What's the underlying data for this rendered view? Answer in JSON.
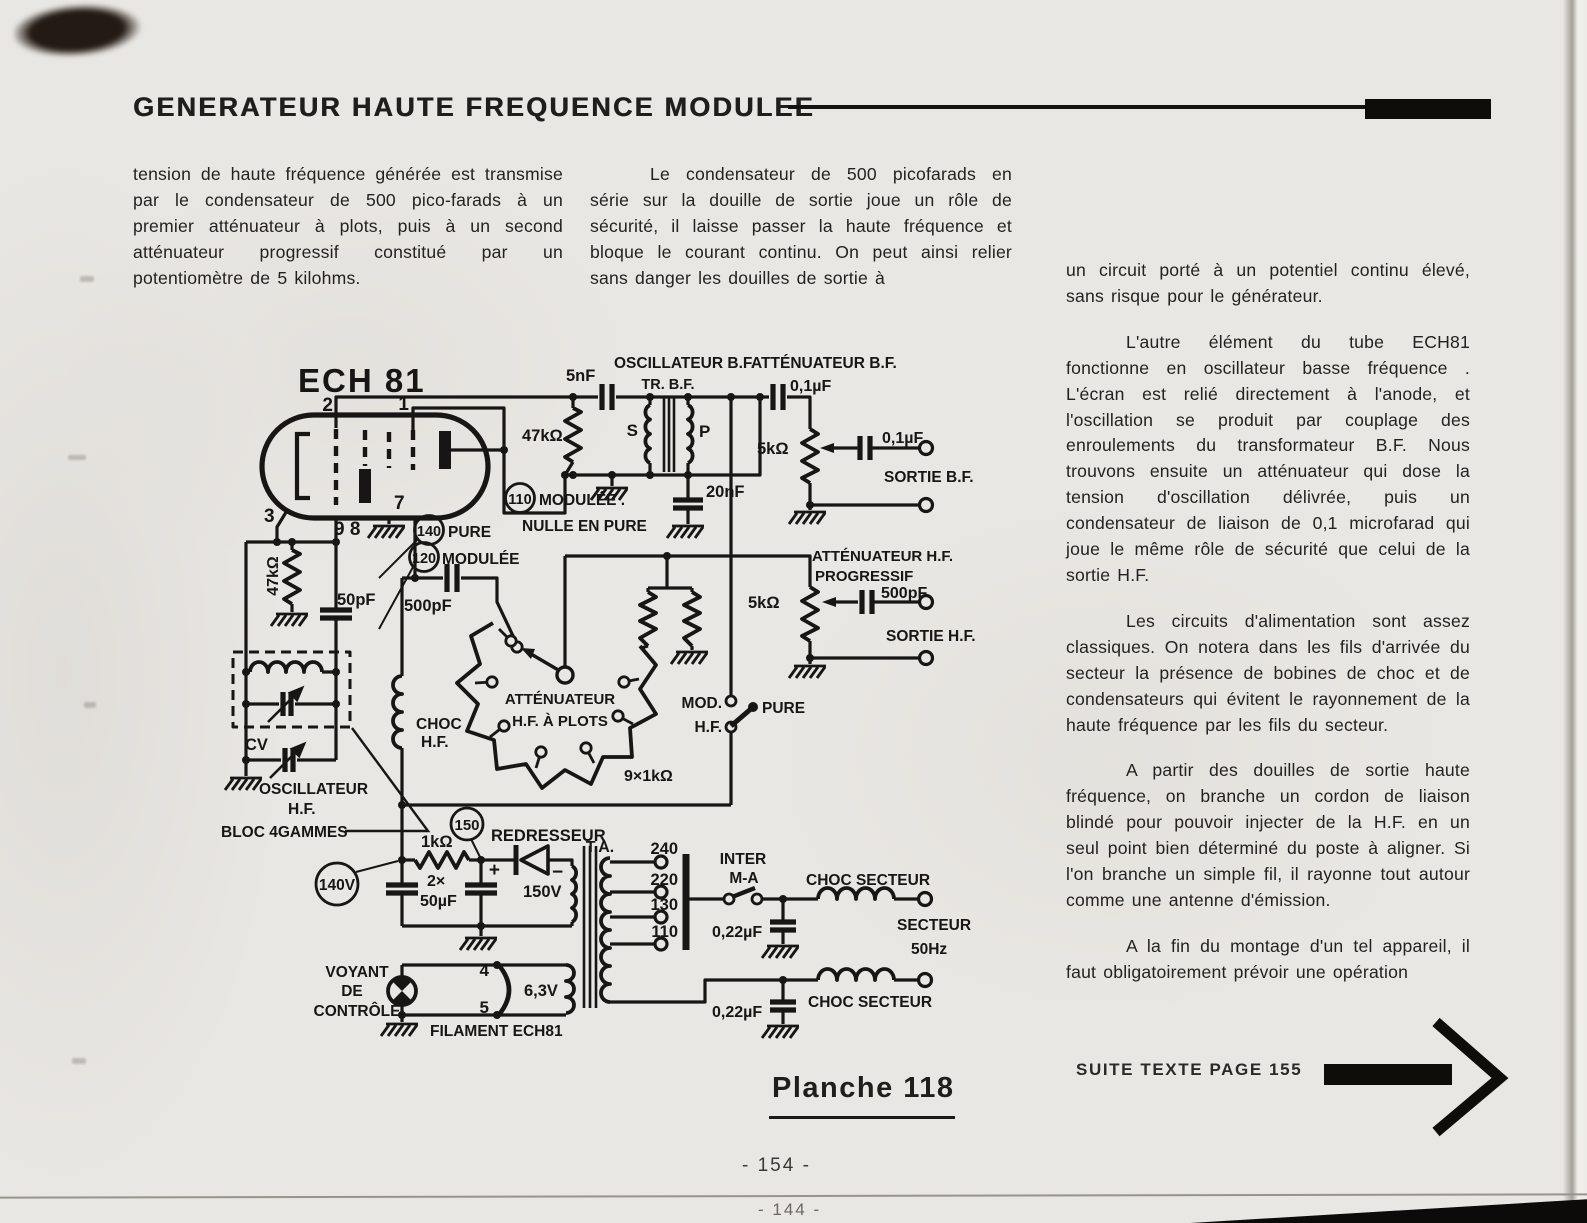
{
  "header": {
    "title": "GENERATEUR HAUTE FREQUENCE MODULEE"
  },
  "body": {
    "col_left": "tension de haute fréquence générée est transmise par le condensateur de 500 pico-farads à un premier atténuateur à plots, puis à un second atténuateur progressif constitué par un potentiomètre de 5 kilohms.",
    "col_middle": "Le condensateur de 500 picofarads en série sur la douille de sortie joue un rôle de sécurité, il laisse passer la haute fréquence et bloque le courant continu. On peut ainsi relier sans danger les douilles de sortie à",
    "col_right_p1": "un circuit porté à un potentiel continu élevé, sans risque pour le générateur.",
    "col_right_p2": "L'autre élément du tube ECH81 fonctionne en oscillateur basse fréquence . L'écran est relié directement à l'anode, et l'oscillation se produit par couplage des enroulements du transformateur B.F. Nous trouvons ensuite un atténuateur qui dose la tension d'oscillation délivrée, puis un condensateur de liaison de 0,1 microfarad qui joue le même rôle de sécurité que celui de la sortie H.F.",
    "col_right_p3": "Les circuits d'alimentation sont assez classiques. On notera dans les fils d'arrivée du secteur la présence de bobines de choc et de condensateurs qui évitent le rayonnement de la haute fréquence par les fils du secteur.",
    "col_right_p4": "A partir des douilles de sortie haute fréquence, on branche un cordon de liaison blindé pour pouvoir injecter de la H.F. en un seul point bien déterminé du poste à aligner. Si l'on branche un simple fil, il rayonne tout autour comme une antenne d'émission.",
    "col_right_p5": "A la fin du montage d'un tel appareil, il faut obligatoirement prévoir une opération"
  },
  "figure": {
    "caption": "Planche 118",
    "continuation": "SUITE TEXTE PAGE 155",
    "page_number": "- 154 -",
    "page_number_overleaf": "- 144 -"
  },
  "schematic": {
    "labels": {
      "tube": "ECH 81",
      "pin1": "1",
      "pin2": "2",
      "pin3": "3",
      "pin7": "7",
      "pin98": "9 8",
      "v110": "110",
      "v110a": "MODULÉE .",
      "v110b": "NULLE EN PURE",
      "v140": "140",
      "v140t": "PURE",
      "v120": "120",
      "v120t": "MODULÉE",
      "r47k_g": "47kΩ",
      "c50": "50pF",
      "c500a": "500pF",
      "cv": "CV",
      "osc1": "OSCILLATEUR",
      "osc2": "H.F.",
      "bloc": "BLOC 4GAMMES",
      "choc1": "CHOC",
      "choc2": "H.F.",
      "attp1": "ATTÉNUATEUR",
      "attp2": "H.F. À PLOTS",
      "r9k": "9×1kΩ",
      "mod": "MOD.",
      "hf": "H.F.",
      "pure": "PURE",
      "oscbf": "OSCILLATEUR B.F.",
      "trbf": "TR. B.F.",
      "c5nf": "5nF",
      "r47k_bf": "47kΩ",
      "s": "S",
      "p": "P",
      "c20nf": "20nF",
      "attbf": "ATTÉNUATEUR B.F.",
      "c01a": "0,1µF",
      "r5k_bf": "5kΩ",
      "c01b": "0,1µF",
      "sortiebf": "SORTIE B.F.",
      "atthf1": "ATTÉNUATEUR H.F.",
      "atthf2": "PROGRESSIF",
      "r5k_hf": "5kΩ",
      "c500b": "500pF",
      "sortiehf": "SORTIE H.F.",
      "v140v": "140V",
      "r1k": "1kΩ",
      "v150": "150",
      "redresseur": "REDRESSEUR",
      "v150v": "150V",
      "plus": "+",
      "minus": "−",
      "ta": "T.A.",
      "r2x": "2×",
      "c50uf": "50µF",
      "t240": "240",
      "t220": "220",
      "t130": "130",
      "t110": "110",
      "inter": "INTER",
      "ma": "M-A",
      "chocsec1": "CHOC SECTEUR",
      "c022a": "0,22µF",
      "secteur": "SECTEUR",
      "hz": "50Hz",
      "c022b": "0,22µF",
      "chocsec2": "CHOC SECTEUR",
      "voyant1": "VOYANT",
      "voyant2": "DE",
      "voyant3": "CONTRÔLE",
      "p4": "4",
      "p5": "5",
      "v63": "6,3V",
      "filament": "FILAMENT ECH81"
    }
  }
}
